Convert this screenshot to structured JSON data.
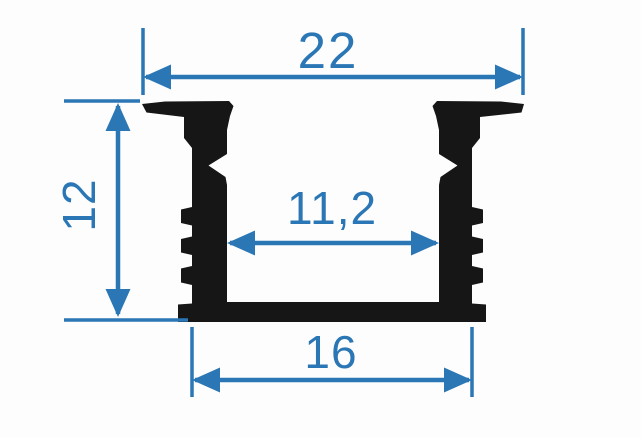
{
  "drawing": {
    "name": "led-profile-cross-section",
    "dimensions": [
      {
        "id": "overall-width-top",
        "value": "22"
      },
      {
        "id": "overall-height",
        "value": "12"
      },
      {
        "id": "inner-width",
        "value": "11,2"
      },
      {
        "id": "base-width-bottom",
        "value": "16"
      }
    ],
    "colors": {
      "dimension": "#2b77b5",
      "profile": "#161616",
      "background": "#fdfdfd"
    }
  }
}
